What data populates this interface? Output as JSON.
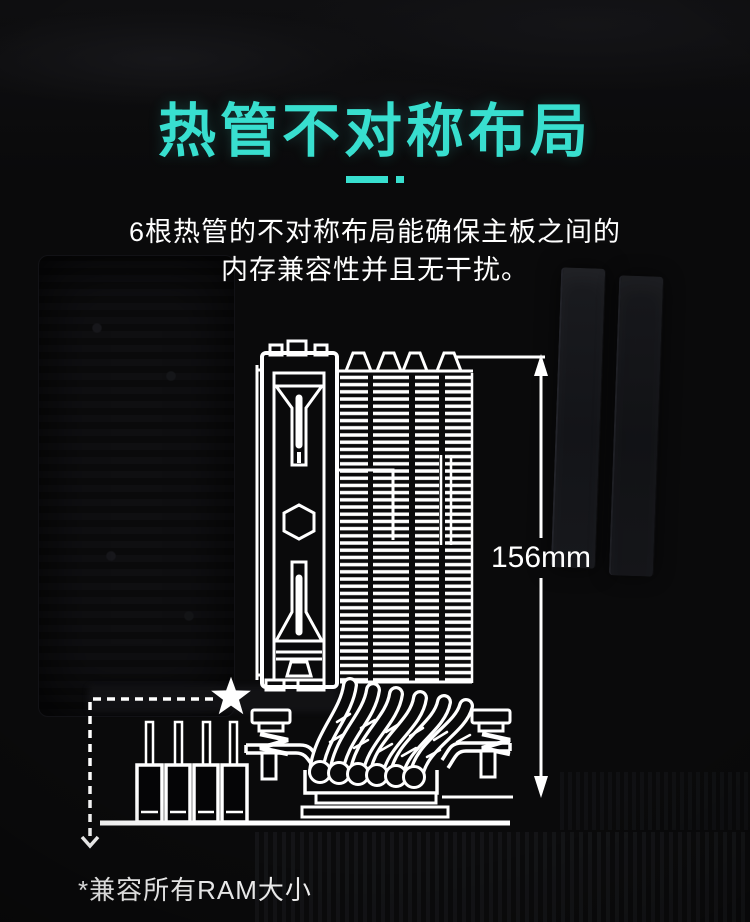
{
  "theme": {
    "background": "#0a0a0b",
    "accent": "#38dfcf",
    "text_color": "#ffffff",
    "line_color": "#ffffff"
  },
  "header": {
    "title": "热管不对称布局",
    "subtitle_line1": "6根热管的不对称布局能确保主板之间的",
    "subtitle_line2": "内存兼容性并且无干扰。"
  },
  "diagram": {
    "height_dimension": "156mm",
    "footnote": "*兼容所有RAM大小",
    "icons": {
      "star-icon": "★",
      "down-arrow-icon": "⌄"
    }
  }
}
